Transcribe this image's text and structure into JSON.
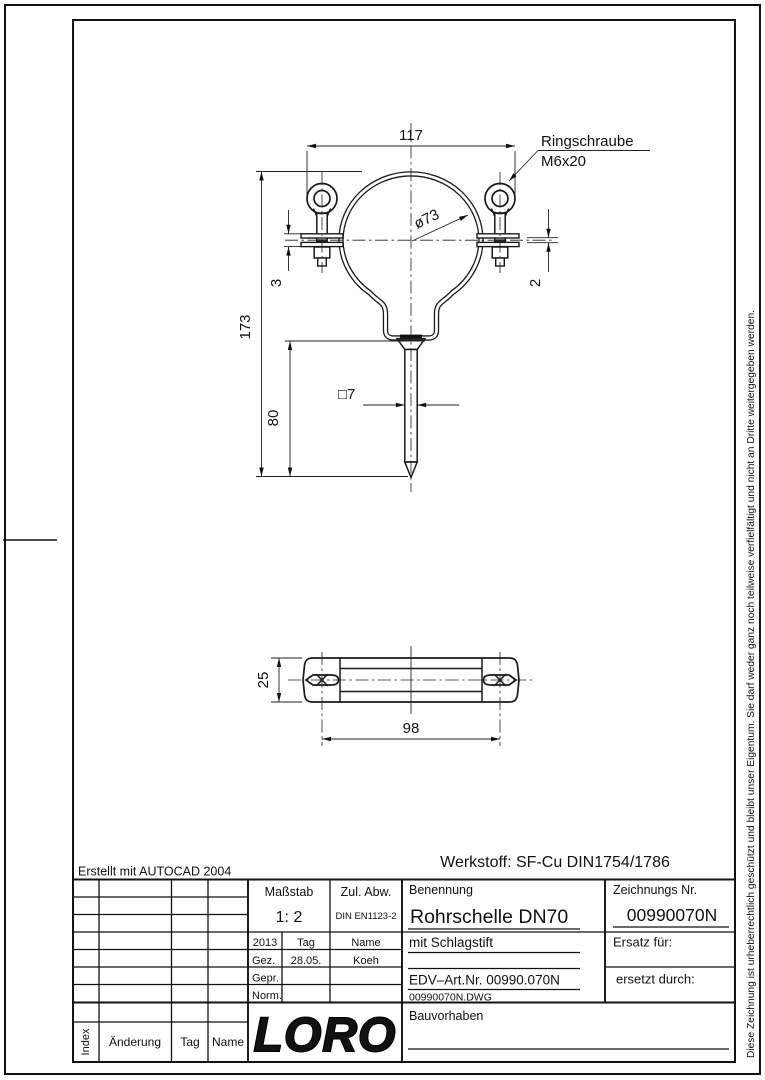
{
  "annotations": {
    "created_with": "Erstellt mit AUTOCAD 2004",
    "material": "Werkstoff: SF-Cu DIN1754/1786",
    "copyright": "Diese Zeichnung ist urheberrechtlich geschützt und bleibt unser Eigentum. Sie darf weder ganz noch teilweise verfielfältigt und nicht an Dritte weitergegeben werden."
  },
  "front_view": {
    "dim_width": "117",
    "dim_height": "173",
    "dim_pin": "80",
    "dim_plate": "3",
    "dim_band": "2",
    "dim_square": "□7",
    "dim_diameter": "ø73",
    "callout_line1": "Ringschraube",
    "callout_line2": "M6x20"
  },
  "top_view": {
    "dim_width": "25",
    "dim_holes": "98"
  },
  "title_block": {
    "masstab": {
      "label": "Maßstab",
      "value": "1: 2"
    },
    "zul_abw": {
      "label": "Zul. Abw.",
      "value": "DIN EN1123-2"
    },
    "approval": {
      "year": "2013",
      "tag": "Tag",
      "name": "Name",
      "gez": "Gez.",
      "gez_tag": "28.05.",
      "gez_name": "Koeh",
      "gepr": "Gepr.",
      "norm": "Norm."
    },
    "logo": "LORO",
    "benennung": {
      "label": "Benennung",
      "value": "Rohrschelle DN70",
      "line2": "mit Schlagstift",
      "edv": "EDV–Art.Nr. 00990.070N",
      "file": "00990070N.DWG"
    },
    "zeichnung": {
      "label": "Zeichnungs Nr.",
      "value": "00990070N",
      "ersatz": "Ersatz für:",
      "ersetzt": "ersetzt durch:"
    },
    "bauvorhaben": "Bauvorhaben"
  },
  "revision_table": {
    "index": "Index",
    "aenderung": "Änderung",
    "tag": "Tag",
    "name": "Name"
  }
}
